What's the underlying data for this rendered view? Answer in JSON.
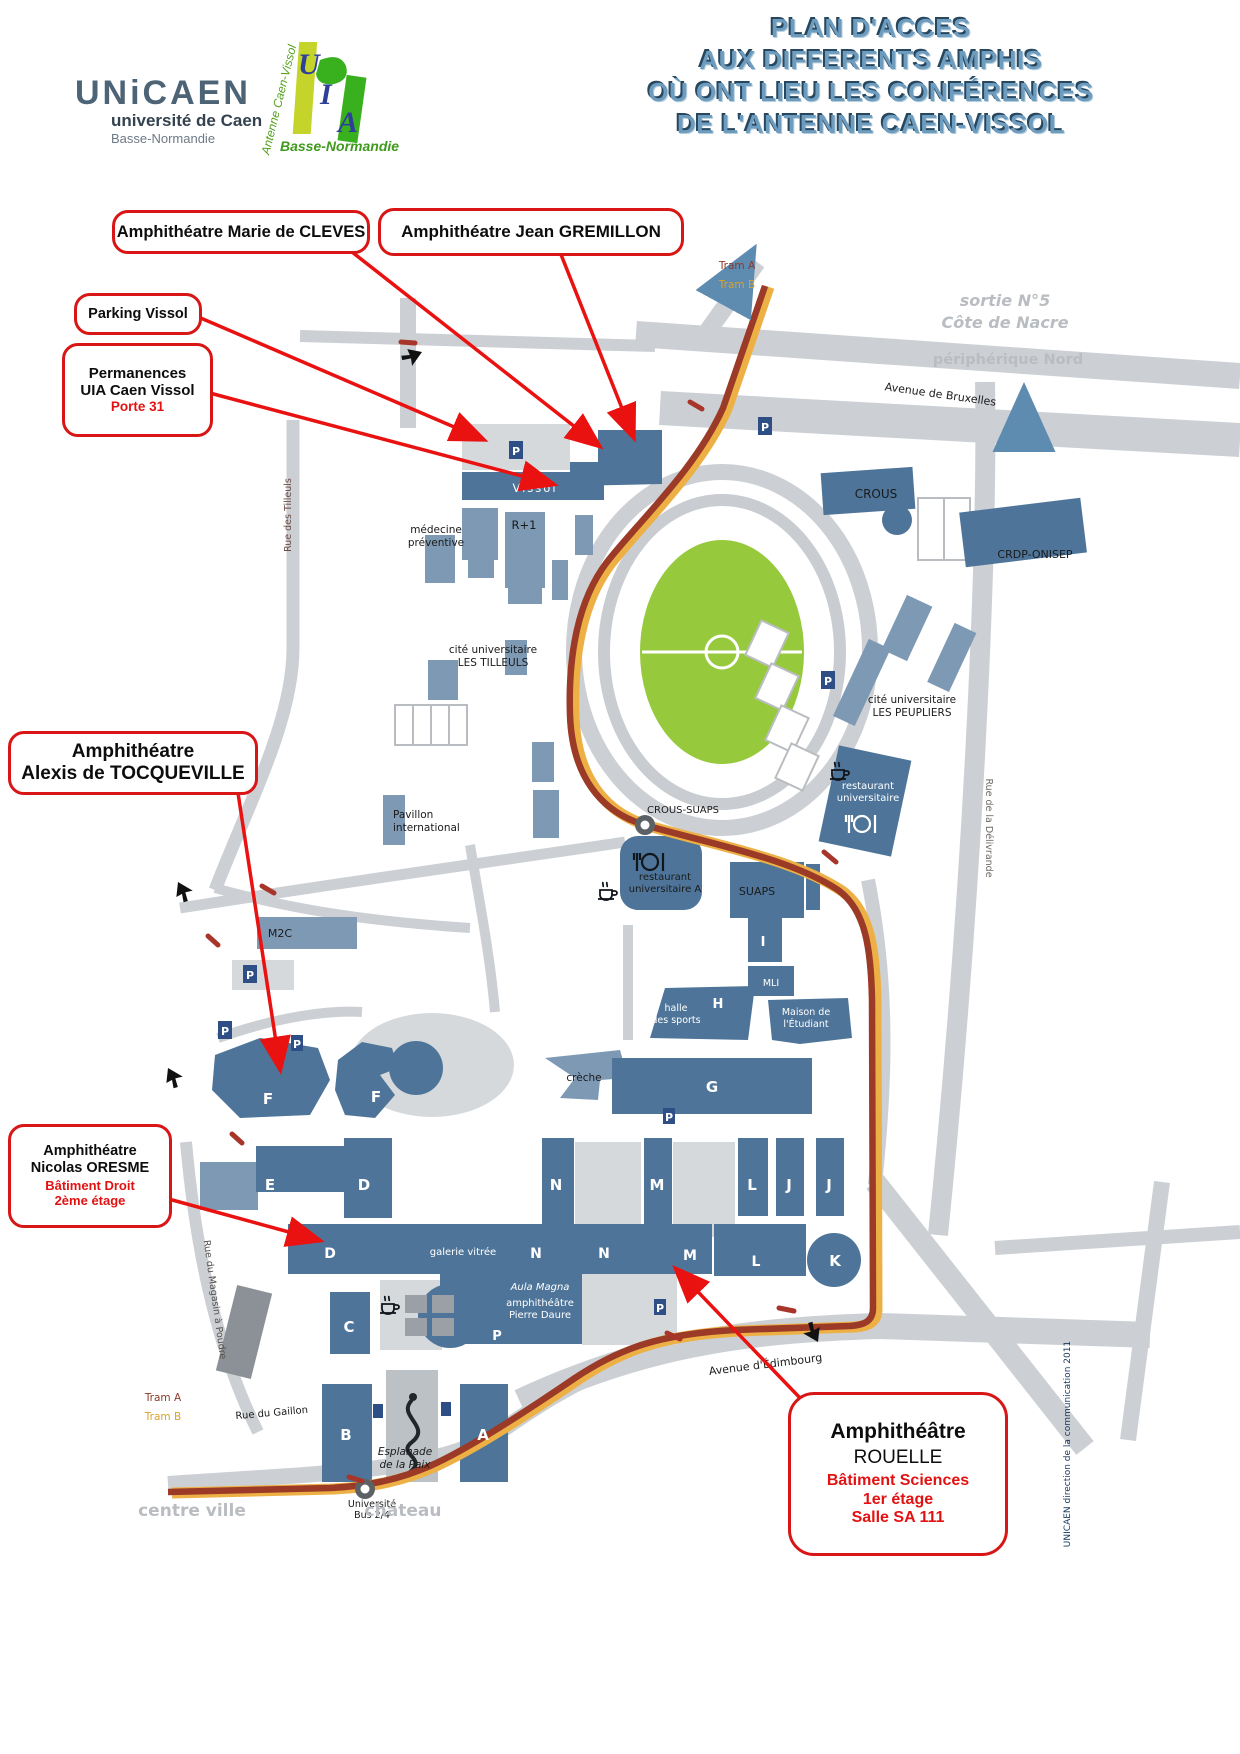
{
  "header": {
    "unicaen": {
      "wordmark": "UNiCAEN",
      "line1": "université de Caen",
      "line2": "Basse-Normandie"
    },
    "uia": {
      "vertical": "Antenne Caen-Vissol",
      "u": "U",
      "i": "I",
      "a": "A",
      "bottom": "Basse-Normandie"
    },
    "title": {
      "line1": "PLAN D'ACCES",
      "line2": "AUX DIFFERENTS AMPHIS",
      "line3": "OÙ ONT LIEU LES CONFÉRENCES",
      "line4": "DE L'ANTENNE CAEN-VISSOL"
    }
  },
  "callouts": {
    "cleves": {
      "label": "Amphithéatre Marie de CLEVES"
    },
    "gremillon": {
      "label": "Amphithéatre Jean GREMILLON"
    },
    "parking": {
      "label": "Parking Vissol"
    },
    "permanences": {
      "line1": "Permanences",
      "line2": "UIA Caen Vissol",
      "line3": "Porte 31"
    },
    "tocqueville": {
      "line1": "Amphithéatre",
      "line2": "Alexis de TOCQUEVILLE"
    },
    "oresme": {
      "line1": "Amphithéatre",
      "line2": "Nicolas ORESME",
      "line3": "Bâtiment Droit",
      "line4": "2ème étage"
    },
    "rouelle": {
      "line1": "Amphithéâtre",
      "line2": "ROUELLE",
      "line3": "Bâtiment Sciences",
      "line4": "1er étage",
      "line5": "Salle SA 111"
    }
  },
  "map": {
    "trams": {
      "a": "Tram A",
      "b": "Tram B"
    },
    "context": {
      "sortie": "sortie N°5",
      "cote": "Côte de Nacre",
      "periph": "périphérique Nord",
      "centre": "centre ville",
      "chateau": "château"
    },
    "streets": {
      "bruxelles": "Avenue de Bruxelles",
      "delivrande": "Rue de la Délivrande",
      "tilleuls": "Rue des Tilleuls",
      "magasin": "Rue du Magasin à Poudre",
      "gaillon": "Rue du Gaillon",
      "edimbourg": "Avenue d'Édimbourg"
    },
    "places": {
      "crous": "CROUS",
      "crdp": "CRDP-ONISEP",
      "cite_tilleuls1": "cité universitaire",
      "cite_tilleuls2": "LES TILLEULS",
      "cite_peupliers1": "cité universitaire",
      "cite_peupliers2": "LES PEUPLIERS",
      "medecine1": "médecine",
      "medecine2": "préventive",
      "r1": "R+1",
      "vissol": "Vissol",
      "pavillon1": "Pavillon",
      "pavillon2": "international",
      "crous_suaps": "CROUS-SUAPS",
      "resto_u1": "restaurant",
      "resto_u2": "universitaire",
      "resto_a1": "restaurant",
      "resto_a2": "universitaire A",
      "suaps": "SUAPS",
      "m2c": "M2C",
      "halle1": "halle",
      "halle2": "des sports",
      "maison1": "Maison de",
      "maison2": "l'Étudiant",
      "creche": "crèche",
      "mli": "MLI",
      "galerie": "galerie vitrée",
      "aula": "Aula Magna",
      "pierre1": "amphithéâtre",
      "pierre2": "Pierre Daure",
      "esplanade1": "Esplanade",
      "esplanade2": "de la Paix",
      "bus1": "Université",
      "bus2": "Bus 2/4"
    },
    "letters": {
      "a": "A",
      "b": "B",
      "c": "C",
      "d": "D",
      "e": "E",
      "f": "F",
      "g": "G",
      "h": "H",
      "i": "I",
      "j": "J",
      "k": "K",
      "l": "L",
      "m": "M",
      "n": "N",
      "p": "P"
    },
    "p_icon": "P",
    "credit": "UNICAEN   direction de la communication   2011"
  },
  "colors": {
    "title_blue": "#6e9cbf",
    "callout_border": "#d81616",
    "annotation_red": "#e31212",
    "building_dark": "#4e7599",
    "building_mid": "#7d99b4",
    "road_gray": "#ccd0d4",
    "stadium_green": "#97c93d",
    "tram_red": "#9b3a26",
    "tram_yellow": "#edb045",
    "context_gray": "#b9bdc1",
    "p_icon_navy": "#2d4f86"
  }
}
